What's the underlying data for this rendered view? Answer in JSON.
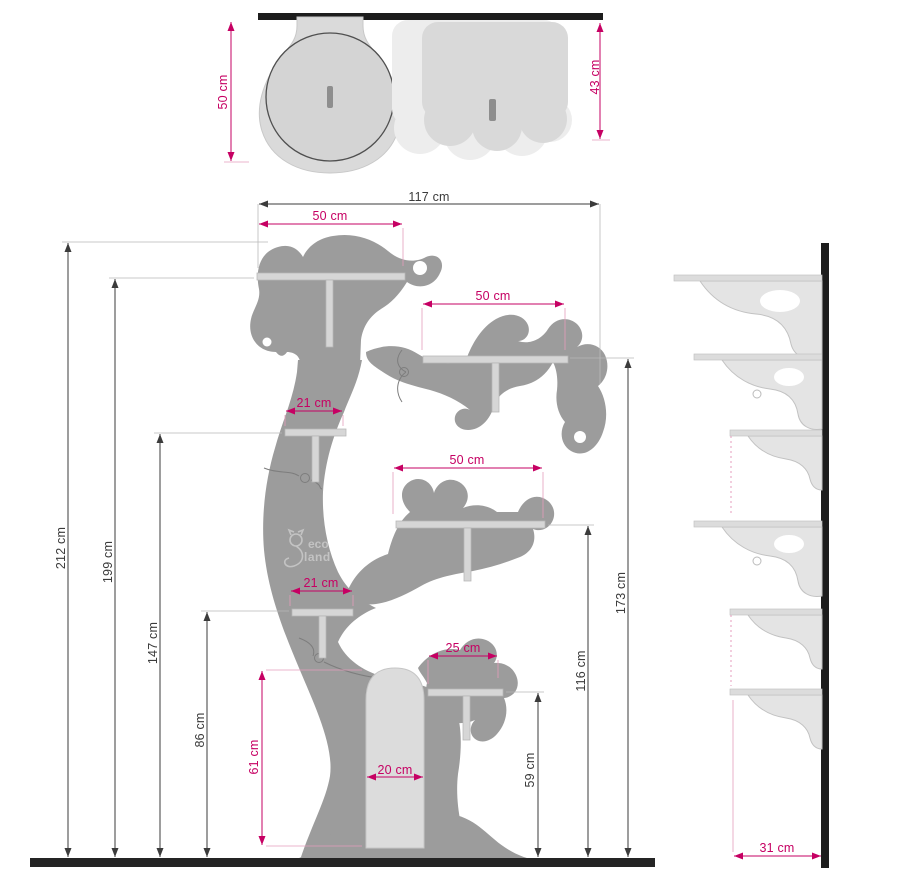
{
  "colors": {
    "accent_pink": "#c60063",
    "dim_dark": "#3b3b3b",
    "tree_gray": "#9c9c9c",
    "panel_gray": "#d9d9d9",
    "panel_light": "#ededed",
    "wall_black": "#1d1d1d"
  },
  "watermark": {
    "line1": "eco",
    "line2": "land"
  },
  "top_view": {
    "left_height": "50 cm",
    "right_height": "43 cm"
  },
  "front_view": {
    "total_width": "117 cm",
    "total_height": "212 cm",
    "top_shelf_height": "199 cm",
    "top_shelf_width": "50 cm",
    "right_shelf_width": "50 cm",
    "right_shelf_height": "173 cm",
    "small_shelf_upper_width": "21 cm",
    "small_shelf_upper_height": "147 cm",
    "middle_shelf_width": "50 cm",
    "middle_shelf_height": "116 cm",
    "small_shelf_lower_width": "21 cm",
    "small_shelf_lower_height": "86 cm",
    "low_shelf_width": "25 cm",
    "low_shelf_height": "59 cm",
    "door_width": "20 cm",
    "door_height": "61 cm"
  },
  "side_view": {
    "shelf_depth": "31 cm"
  }
}
